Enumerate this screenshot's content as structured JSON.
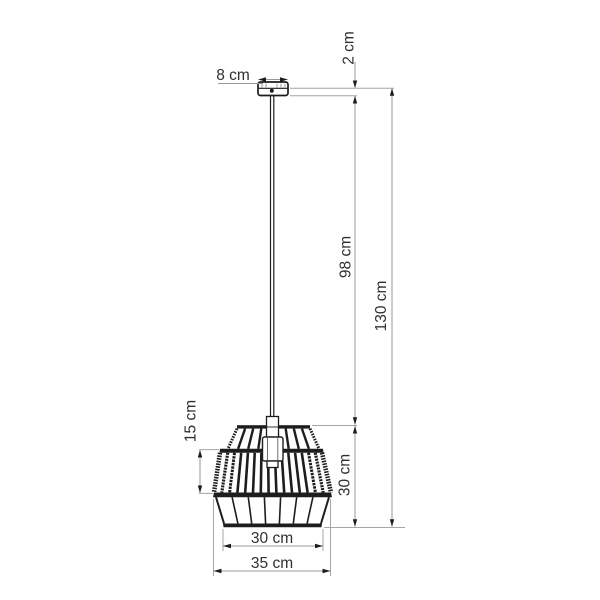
{
  "drawing": {
    "type": "technical-dimension-drawing",
    "subject": "cage pendant ceiling lamp",
    "dimensions": {
      "canopy_width": "8 cm",
      "canopy_height": "2 cm",
      "cord_drop": "98 cm",
      "total_height": "130 cm",
      "band_height": "15 cm",
      "shade_height": "30 cm",
      "bottom_diameter": "30 cm",
      "max_diameter": "35 cm"
    },
    "colors": {
      "background": "#ffffff",
      "ink": "#1d1d1d",
      "dimension_line": "#9a9a9a",
      "text": "#2f2f2f"
    }
  }
}
